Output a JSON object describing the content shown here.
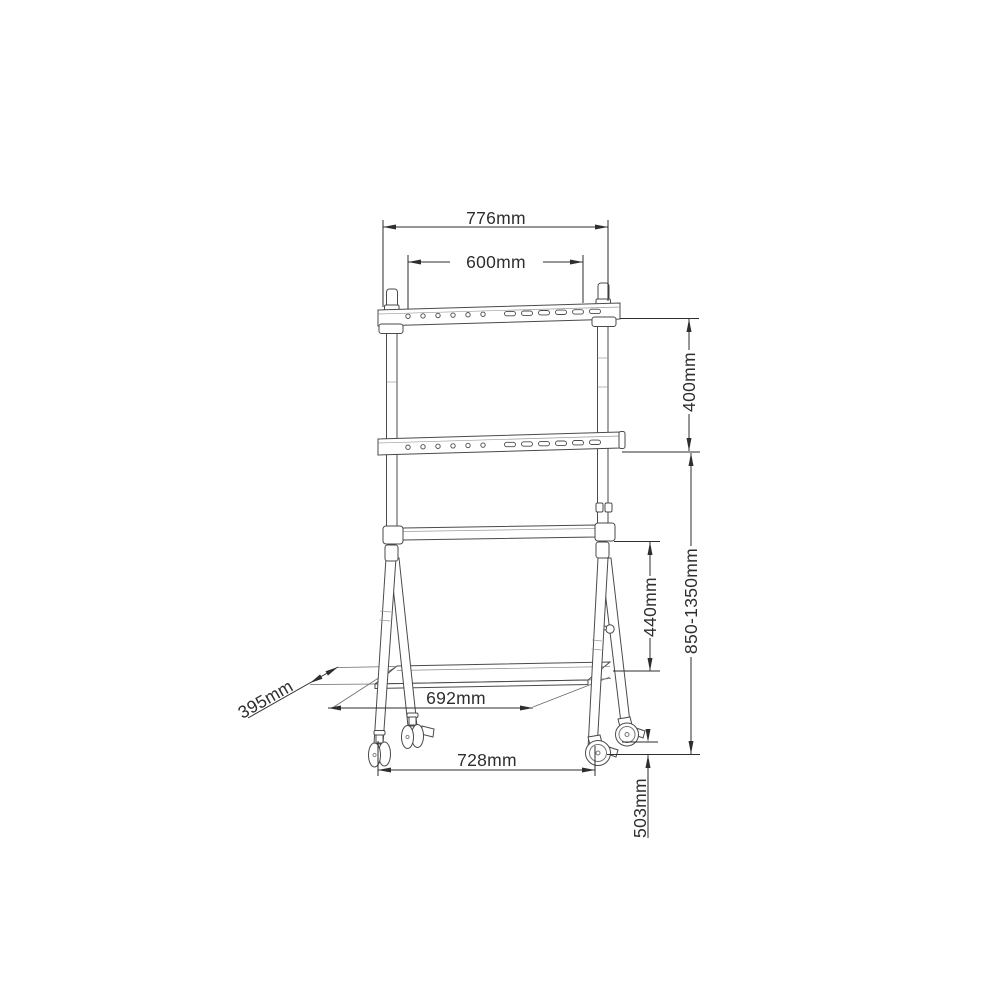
{
  "page": {
    "background": "#ffffff"
  },
  "drawing": {
    "type": "technical-dimension-diagram",
    "structure_line_color": "#4a4a4a",
    "dimension_line_color": "#2e2e2e",
    "dimensions": {
      "outer_width": "776mm",
      "vesa_width": "600mm",
      "vesa_height": "400mm",
      "height_range": "850-1350mm",
      "crossbar_to_shelf": "440mm",
      "front_wheel_span": "692mm",
      "shelf_depth": "395mm",
      "wheel_span": "728mm",
      "base_depth": "503mm"
    }
  }
}
